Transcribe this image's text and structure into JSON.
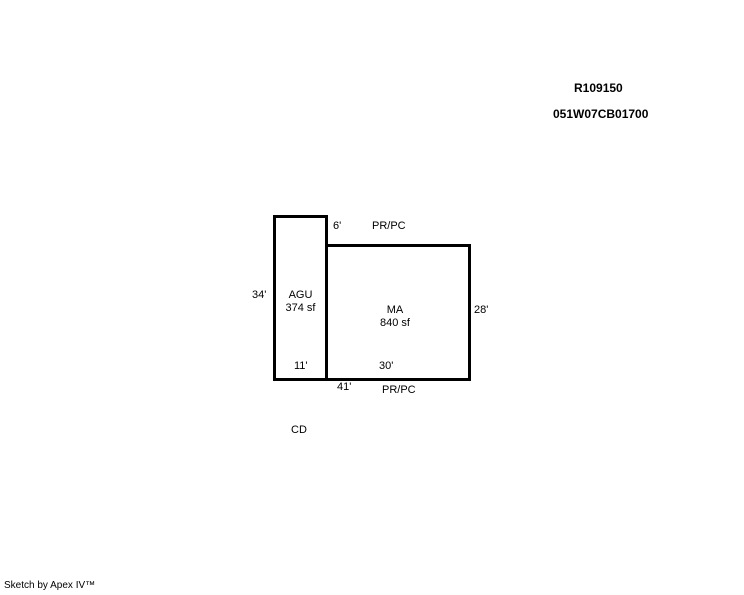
{
  "canvas": {
    "background": "#ffffff",
    "ink": "#000000"
  },
  "header": {
    "record_id": "R109150",
    "parcel_id": "051W07CB01700"
  },
  "sketch": {
    "agu": {
      "name": "AGU",
      "area": "374 sf",
      "left_dim": "34'",
      "bottom_dim": "11'"
    },
    "ma": {
      "name": "MA",
      "area": "840 sf",
      "right_dim": "28'",
      "bottom_dim": "30'"
    },
    "top_offset_dim": "6'",
    "total_bottom_dim": "41'",
    "boundary_top_label": "PR/PC",
    "boundary_bottom_label": "PR/PC",
    "cd_label": "CD"
  },
  "footer": {
    "credit": "Sketch by Apex IV™"
  }
}
